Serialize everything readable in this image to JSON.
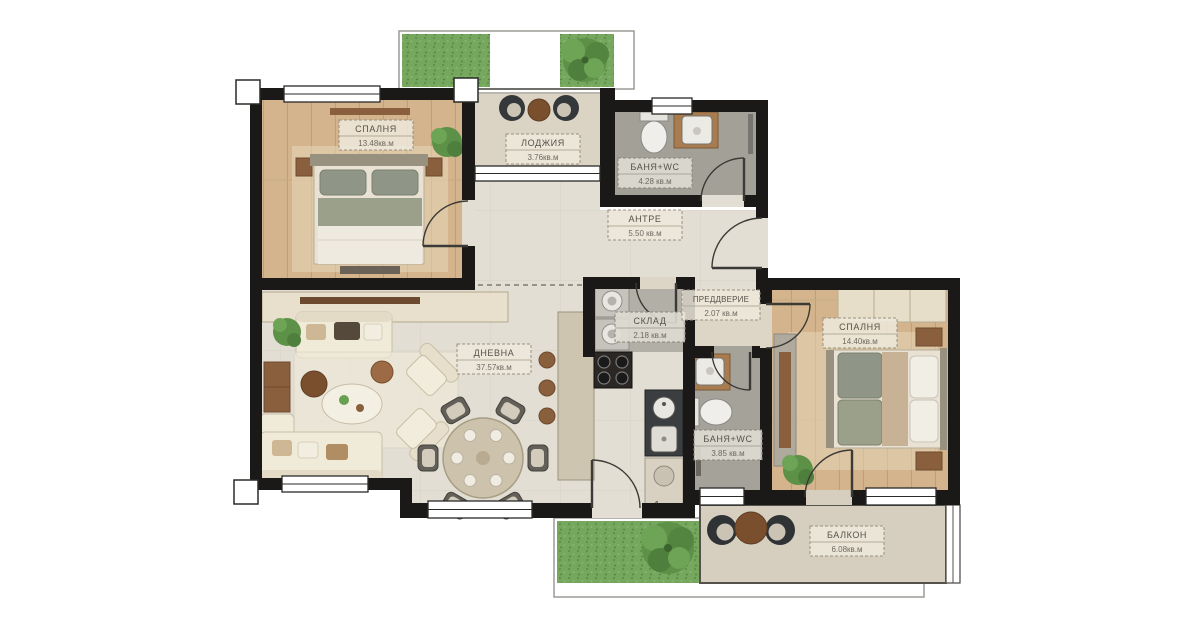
{
  "plan": {
    "rooms": [
      {
        "id": "bedroom-1",
        "name": "СПАЛНЯ",
        "area": "13.48кв.м"
      },
      {
        "id": "loggia",
        "name": "ЛОДЖИЯ",
        "area": "3.76кв.м"
      },
      {
        "id": "bathroom-1",
        "name": "БАНЯ+WC",
        "area": "4.28 кв.м"
      },
      {
        "id": "entry-hall",
        "name": "АНТРЕ",
        "area": "5.50 кв.м"
      },
      {
        "id": "storage",
        "name": "СКЛАД",
        "area": "2.18 кв.м"
      },
      {
        "id": "vestibule",
        "name": "ПРЕДДВЕРИЕ",
        "area": "2.07 кв.м"
      },
      {
        "id": "bedroom-2",
        "name": "СПАЛНЯ",
        "area": "14.40кв.м"
      },
      {
        "id": "living-room",
        "name": "ДНЕВНА",
        "area": "37.57кв.м"
      },
      {
        "id": "bathroom-2",
        "name": "БАНЯ+WC",
        "area": "3.85 кв.м"
      },
      {
        "id": "balcony",
        "name": "БАЛКОН",
        "area": "6.08кв.м"
      }
    ],
    "markers": {
      "kitchen_unit": "1"
    },
    "colors": {
      "wall": "#1a1918",
      "wood_floor": "#d3b48c",
      "living_floor": "#e2ded3",
      "bath_floor": "#a3a098",
      "storage_floor": "#b2afa7",
      "balcony_floor": "#d6cfbf",
      "grass": "#76a75e",
      "furniture_cream": "#f0ead9",
      "furniture_wood": "#8a5f3e",
      "dark_fixture": "#35393b"
    }
  }
}
